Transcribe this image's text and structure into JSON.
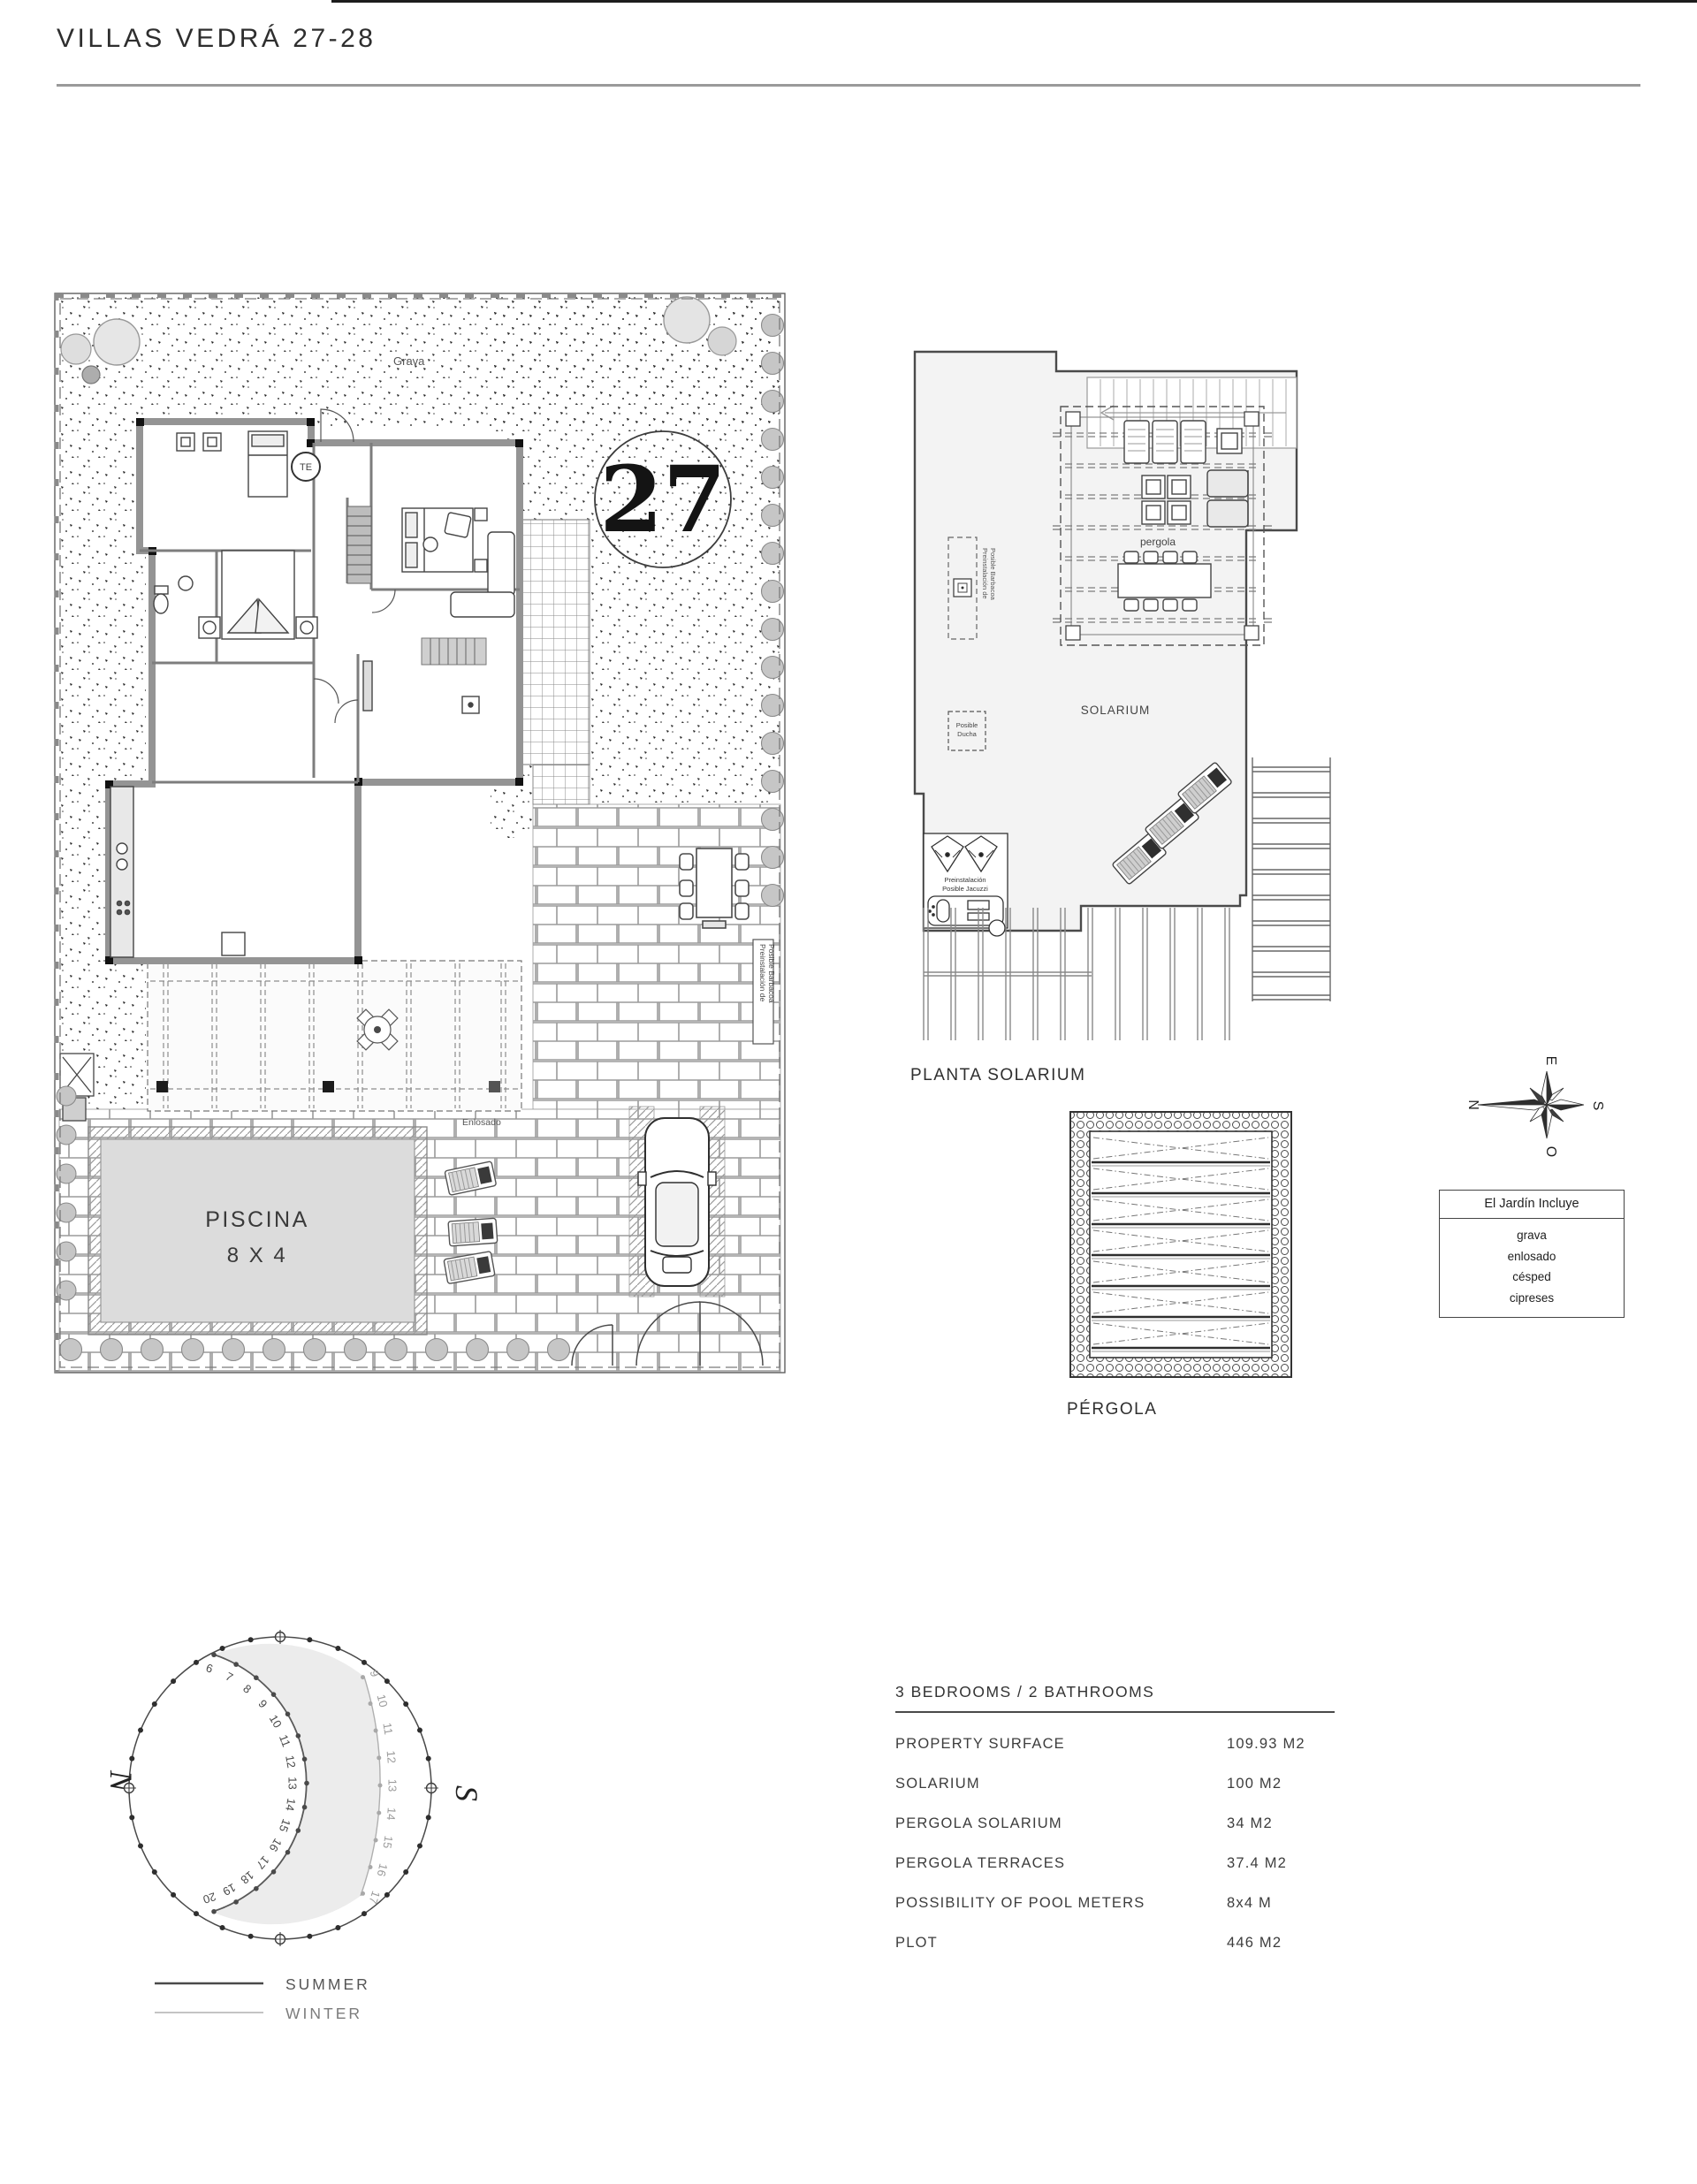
{
  "page": {
    "title": "VILLAS VEDRÁ 27-28"
  },
  "site_plan": {
    "unit_number": "27",
    "grava_label": "Grava",
    "enlosado_label": "Enlosado",
    "pool_label_line1": "PISCINA",
    "pool_label_line2": "8 X 4",
    "te_label": "TE",
    "barbacoa_label_line1": "Preinstalación de",
    "barbacoa_label_line2": "Posible Barbacoa"
  },
  "solarium_plan": {
    "title": "PLANTA SOLARIUM",
    "solarium_label": "SOLARIUM",
    "pergola_label": "pergola",
    "ducha_label_line1": "Posible",
    "ducha_label_line2": "Ducha",
    "jacuzzi_label_line1": "Preinstalación",
    "jacuzzi_label_line2": "Posible Jacuzzi",
    "barbacoa_label_line1": "Preinstalación de",
    "barbacoa_label_line2": "Posible Barbacoa"
  },
  "pergola_plan": {
    "title": "PÉRGOLA"
  },
  "compass": {
    "north": "N",
    "south": "S",
    "east": "E",
    "west": "O"
  },
  "garden_box": {
    "title": "El Jardín Incluye",
    "items": [
      "grava",
      "enlosado",
      "césped",
      "cipreses"
    ]
  },
  "sun_diagram": {
    "north_label": "N",
    "south_label": "S",
    "summer_hours": [
      6,
      7,
      8,
      9,
      10,
      11,
      12,
      13,
      14,
      15,
      16,
      17,
      18,
      19,
      20
    ],
    "winter_hours": [
      9,
      10,
      11,
      12,
      13,
      14,
      15,
      16,
      17
    ],
    "legend": [
      {
        "label": "SUMMER"
      },
      {
        "label": "WINTER"
      }
    ]
  },
  "specs": {
    "title": "3 BEDROOMS / 2 BATHROOMS",
    "rows": [
      {
        "label": "PROPERTY SURFACE",
        "value": "109.93 M2"
      },
      {
        "label": "SOLARIUM",
        "value": "100 M2"
      },
      {
        "label": "PERGOLA SOLARIUM",
        "value": "34 M2"
      },
      {
        "label": "PERGOLA TERRACES",
        "value": "37.4 M2"
      },
      {
        "label": "POSSIBILITY OF POOL METERS",
        "value": "8x4 M"
      },
      {
        "label": "PLOT",
        "value": "446 M2"
      }
    ]
  }
}
